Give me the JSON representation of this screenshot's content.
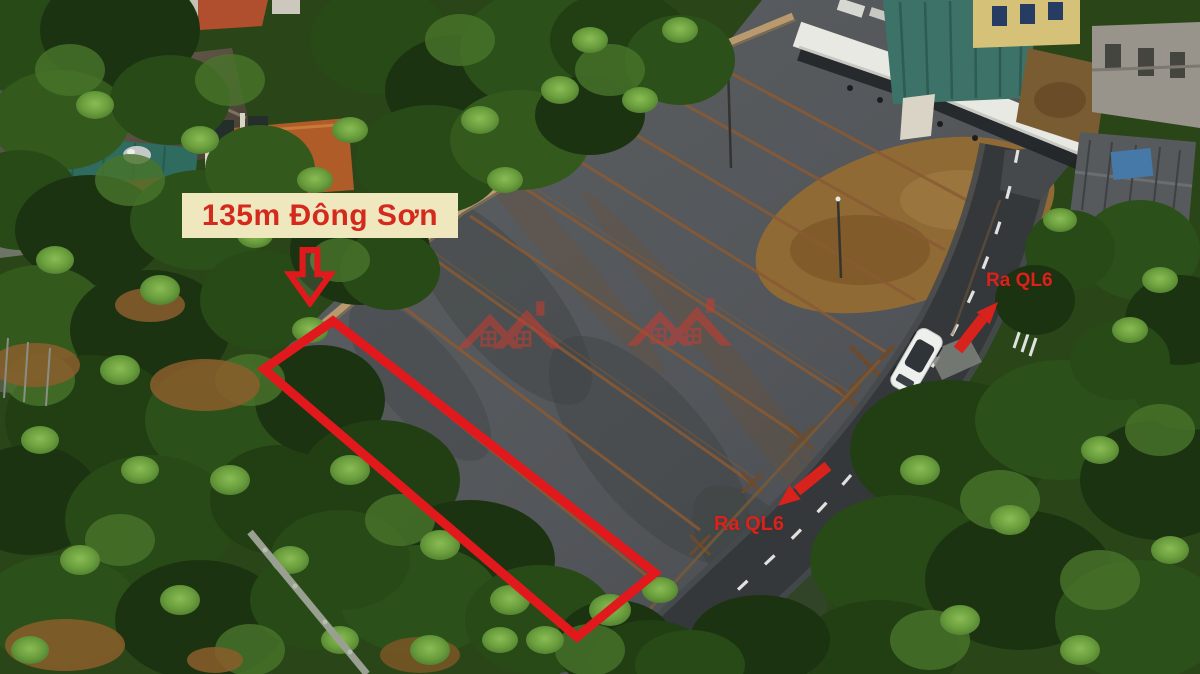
{
  "photo": {
    "description": "Aerial drone view of subdivided land plots beside a curved asphalt road",
    "elements": [
      "parking-lot-plots",
      "road-with-dashed-line",
      "white-car",
      "white-canopy",
      "village-houses",
      "trees"
    ]
  },
  "annotations": {
    "plot_label": "135m Đông Sơn",
    "direction_top": {
      "label": "Ra QL6"
    },
    "direction_bottom": {
      "label": "Ra QL6"
    }
  },
  "colors": {
    "annotation_red": "#e2191c",
    "label_background": "#efe7bd",
    "label_text": "#d42a1e",
    "watermark_red": "#cf3a2e"
  },
  "icons": {
    "watermark": "house-roofs-logo",
    "down_arrow": "block-arrow-down",
    "top_arrow": "arrow-up-right",
    "bottom_arrow": "arrow-down-left"
  }
}
